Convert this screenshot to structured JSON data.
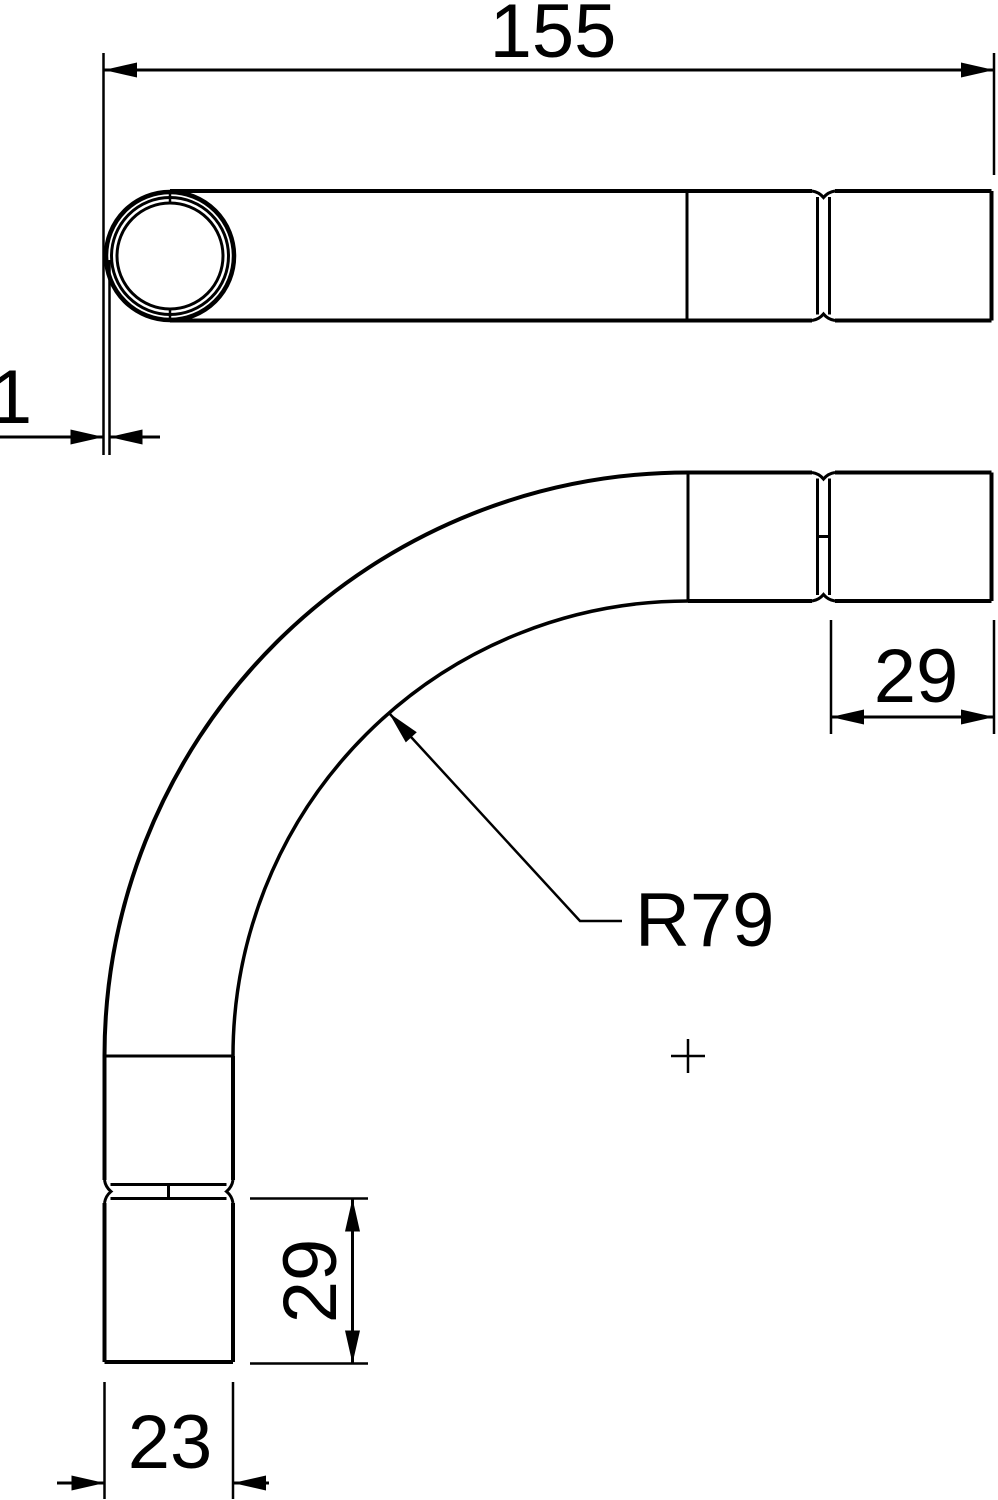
{
  "drawing": {
    "background_color": "#ffffff",
    "line_color": "#000000"
  },
  "dimensions": {
    "overall_length": "155",
    "wall_thickness": "1",
    "socket_depth_right": "29",
    "socket_depth_bottom": "29",
    "outer_diameter": "23",
    "bend_radius": "R79"
  }
}
